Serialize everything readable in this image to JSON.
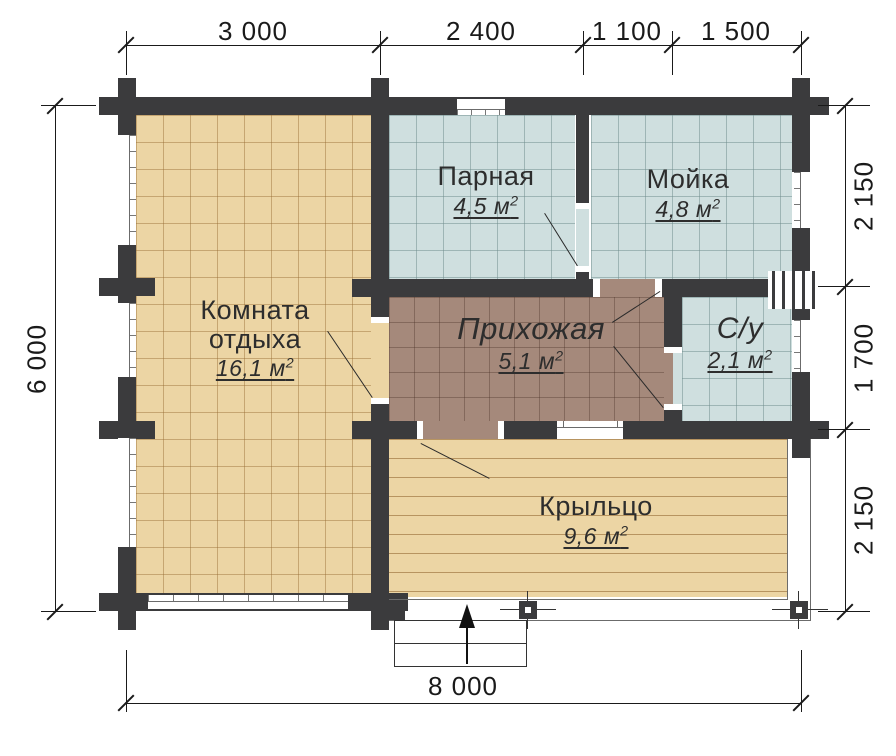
{
  "plan": {
    "dims": {
      "top": [
        "3 000",
        "2 400",
        "1 100",
        "1 500"
      ],
      "left": "6 000",
      "right": [
        "2 150",
        "1 700",
        "2 150"
      ],
      "bottom": "8 000"
    },
    "rooms": [
      {
        "name": "Комната отдыха",
        "area": "16,1 м",
        "sup": "2"
      },
      {
        "name": "Парная",
        "area": "4,5 м",
        "sup": "2"
      },
      {
        "name": "Мойка",
        "area": "4,8 м",
        "sup": "2"
      },
      {
        "name": "Прихожая",
        "area": "5,1 м",
        "sup": "2"
      },
      {
        "name": "С/у",
        "area": "2,1 м",
        "sup": "2"
      },
      {
        "name": "Крыльцо",
        "area": "9,6 м",
        "sup": "2"
      }
    ],
    "colors": {
      "wall": "#3b3b3d",
      "floor_wood": "#ecd5a4",
      "floor_wet": "#cfdfdf",
      "floor_hall": "#a5897b",
      "annotation": "#1a1a1a"
    }
  }
}
